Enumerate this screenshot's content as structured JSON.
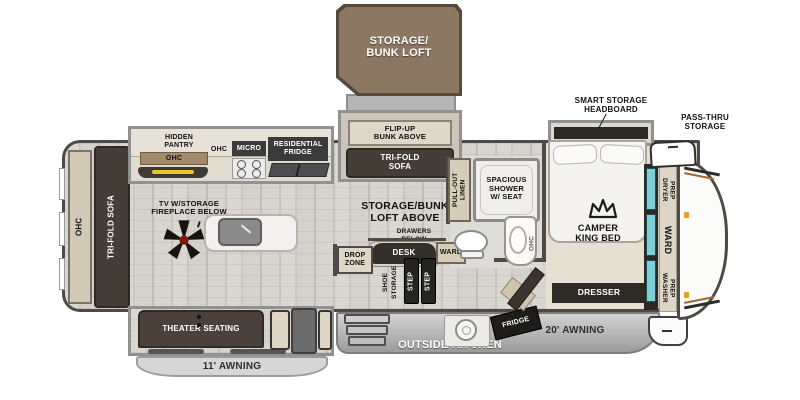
{
  "loft": {
    "label": "STORAGE/\nBUNK LOFT"
  },
  "kitchen": {
    "hidden_pantry": "HIDDEN\nPANTRY",
    "pantry_ohc": "OHC",
    "ohc": "OHC",
    "micro": "MICRO",
    "fridge": "RESIDENTIAL\nFRIDGE"
  },
  "living": {
    "tv": "TV W/STORAGE\nFIREPLACE BELOW",
    "ohc": "OHC",
    "sofa": "TRI-FOLD SOFA",
    "theater": "THEATER SEATING"
  },
  "bunk_room": {
    "flip_up": "FLIP-UP\nBUNK ABOVE",
    "sofa": "TRI-FOLD\nSOFA",
    "loft_above": "STORAGE/BUNK\nLOFT ABOVE",
    "drawers": "DRAWERS\nBELOW",
    "desk": "DESK",
    "ward": "WARD",
    "drop_zone": "DROP\nZONE",
    "shoe": "SHOE",
    "storage": "STORAGE",
    "step": "STEP"
  },
  "bath": {
    "linen": "PULL-OUT\nLINEN",
    "shower": "SPACIOUS\nSHOWER\nW/ SEAT",
    "ohc": "OHC"
  },
  "bedroom": {
    "headboard": "SMART STORAGE\nHEADBOARD",
    "bed": "CAMPER\nKING BED",
    "dresser": "DRESSER",
    "dryer": "DRYER\nPREP",
    "ward": "WARD",
    "washer": "WASHER\nPREP"
  },
  "front": {
    "pass_thru": "PASS-THRU\nSTORAGE"
  },
  "exterior": {
    "outside_kitchen": "OUTSIDE KITCHEN",
    "awning_rear": "11' AWNING",
    "awning_front": "20' AWNING",
    "fridge": "FRIDGE"
  },
  "colors": {
    "loft_brown": "#8b7863",
    "furniture_dark": "#453e37",
    "cabinet_beige": "#d6cdb9",
    "mirror_teal": "#7ed0d4",
    "underlight_yellow": "#e6c52e",
    "fan_hub_red": "#7c1a10",
    "awning_gray": "#c9c9c9"
  }
}
